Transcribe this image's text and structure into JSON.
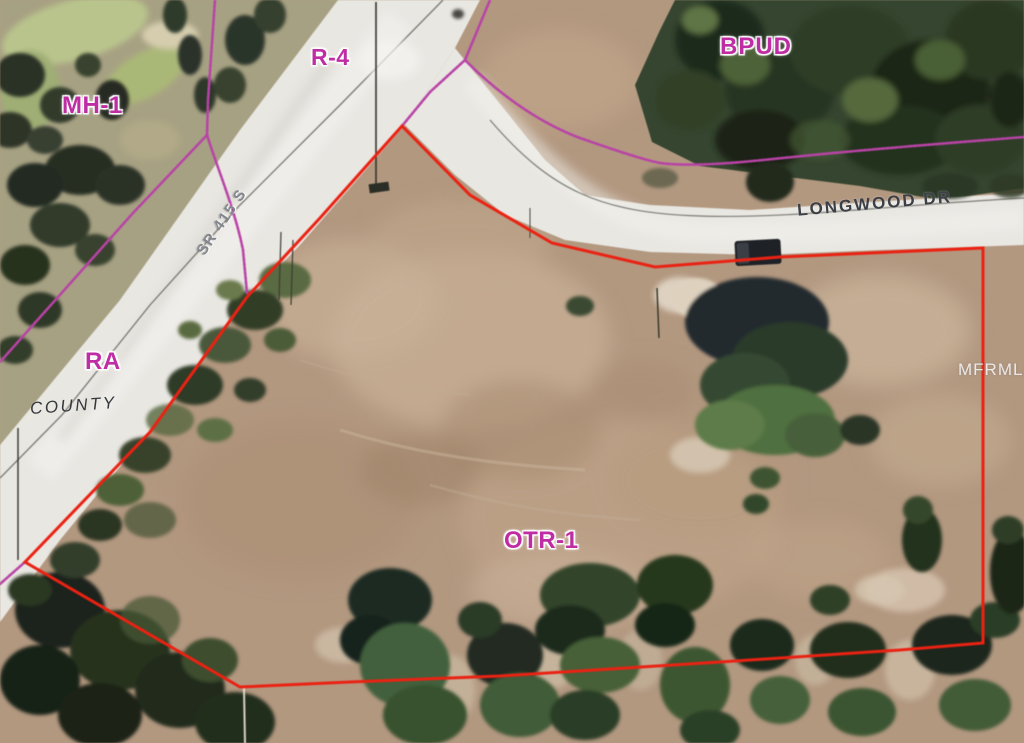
{
  "map": {
    "description_label": "aerial parcel zoning map",
    "zoning_labels": [
      {
        "id": "mh1",
        "text": "MH-1"
      },
      {
        "id": "r4",
        "text": "R-4"
      },
      {
        "id": "bpud",
        "text": "BPUD"
      },
      {
        "id": "ra",
        "text": "RA"
      },
      {
        "id": "otr1",
        "text": "OTR-1"
      }
    ],
    "road_labels": [
      {
        "id": "sr415",
        "text": "SR 415 S"
      },
      {
        "id": "county",
        "text": "COUNTY"
      },
      {
        "id": "longwood",
        "text": "LONGWOOD DR"
      }
    ],
    "watermark": {
      "text": "MFRMLS"
    },
    "colors": {
      "parcel_boundary": "#ea2213",
      "zoning_boundary": "#b843a6",
      "zoning_label_text": "#bf2da4",
      "road_label_text": "#3c4046",
      "road_label_emboss": "#83878d",
      "watermark_text": "#f8f8fa",
      "dirt_field": "#b39880",
      "road_surface": "#e9e7e2",
      "forest": "#35452f"
    }
  }
}
